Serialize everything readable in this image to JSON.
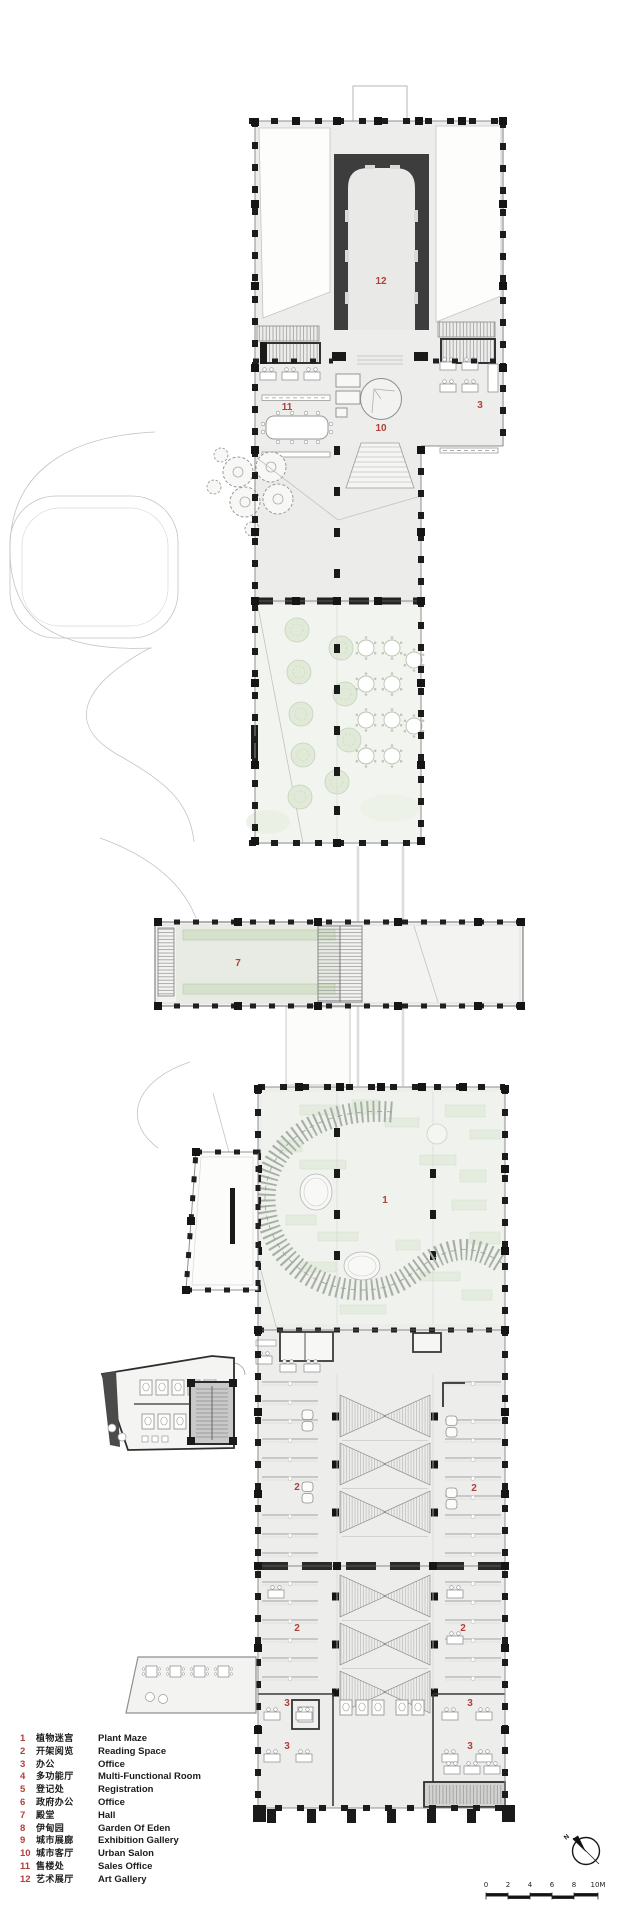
{
  "page": {
    "background": "#ffffff"
  },
  "colors": {
    "label_red": "#b0413a",
    "wall_black": "#1c1c1c",
    "art_gallery_wall": "#3d3d3d",
    "floor_gray": "#ededed",
    "garden_green": "#e1ead8",
    "maze_green": "#e4ecdf",
    "hall_bench_green": "#d5e1cb",
    "path_gray": "#cccccc"
  },
  "plan_labels": {
    "art_gallery": "12",
    "sales_office": "11",
    "urban_salon": "10",
    "office_top": "3",
    "hall": "7",
    "plant_maze": "1",
    "reading_a": "2",
    "reading_b": "2",
    "reading_c": "2",
    "reading_d": "2",
    "office_b1": "3",
    "office_b2": "3",
    "office_b3": "3",
    "office_b4": "3"
  },
  "legend": {
    "items": [
      {
        "num": "1",
        "zh": "植物迷宫",
        "en": "Plant Maze"
      },
      {
        "num": "2",
        "zh": "开架阅览",
        "en": "Reading Space"
      },
      {
        "num": "3",
        "zh": "办公",
        "en": "Office"
      },
      {
        "num": "4",
        "zh": "多功能厅",
        "en": "Multi-Functional Room"
      },
      {
        "num": "5",
        "zh": "登记处",
        "en": "Registration"
      },
      {
        "num": "6",
        "zh": "政府办公",
        "en": "Office"
      },
      {
        "num": "7",
        "zh": "殿堂",
        "en": "Hall"
      },
      {
        "num": "8",
        "zh": "伊甸园",
        "en": "Garden Of Eden"
      },
      {
        "num": "9",
        "zh": "城市展廊",
        "en": "Exhibition Gallery"
      },
      {
        "num": "10",
        "zh": "城市客厅",
        "en": "Urban Salon"
      },
      {
        "num": "11",
        "zh": "售楼处",
        "en": "Sales Office"
      },
      {
        "num": "12",
        "zh": "艺术展厅",
        "en": "Art Gallery"
      }
    ]
  },
  "north_arrow": {
    "label": "N"
  },
  "scale_bar": {
    "ticks": [
      "0",
      "2",
      "4",
      "6",
      "8"
    ],
    "end_label": "10M"
  }
}
